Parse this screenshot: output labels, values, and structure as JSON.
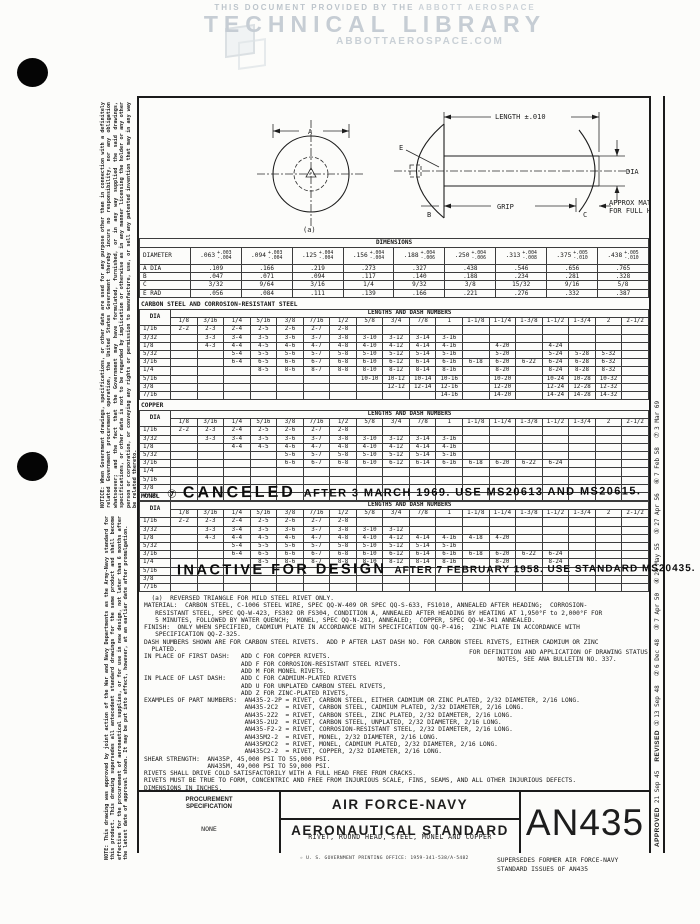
{
  "watermark": {
    "provided_by": "THIS DOCUMENT PROVIDED BY THE",
    "brand": "ABBOTT AEROSPACE",
    "library": "TECHNICAL LIBRARY",
    "site": "ABBOTTAEROSPACE.COM"
  },
  "drawing": {
    "dim_a": "A",
    "caption": "(a)",
    "length": "LENGTH ±.010",
    "e": "E",
    "b": "B",
    "grip": "GRIP",
    "c": "C",
    "dia": "DIA",
    "approx_1": "APPROX MATERIAL",
    "approx_2": "FOR FULL HEAD"
  },
  "dimensions": {
    "title": "DIMENSIONS",
    "row_label": "DIAMETER",
    "diameters": [
      {
        "v": ".063",
        "p": "+.003",
        "m": "-.004"
      },
      {
        "v": ".094",
        "p": "+.003",
        "m": "-.004"
      },
      {
        "v": ".125",
        "p": "+.004",
        "m": "-.004"
      },
      {
        "v": ".156",
        "p": "+.004",
        "m": "-.004"
      },
      {
        "v": ".188",
        "p": "+.004",
        "m": "-.006"
      },
      {
        "v": ".250",
        "p": "+.004",
        "m": "-.006"
      },
      {
        "v": ".313",
        "p": "+.004",
        "m": "-.008"
      },
      {
        "v": ".375",
        "p": "+.005",
        "m": "-.010"
      },
      {
        "v": ".438",
        "p": "+.005",
        "m": "-.010"
      }
    ],
    "rows": [
      {
        "label": "A DIA",
        "values": [
          ".109",
          ".166",
          ".219",
          ".273",
          ".327",
          ".438",
          ".546",
          ".656",
          ".765"
        ]
      },
      {
        "label": "B",
        "values": [
          ".047",
          ".071",
          ".094",
          ".117",
          ".140",
          ".188",
          ".234",
          ".281",
          ".328"
        ]
      },
      {
        "label": "C",
        "values": [
          "3/32",
          "9/64",
          "3/16",
          "1/4",
          "9/32",
          "3/8",
          "15/32",
          "9/16",
          "5/8"
        ]
      },
      {
        "label": "E RAD",
        "values": [
          ".056",
          ".084",
          ".111",
          ".139",
          ".166",
          ".221",
          ".276",
          ".332",
          ".387"
        ]
      }
    ]
  },
  "length_header": {
    "dia": "DIA",
    "title": "LENGTHS AND DASH NUMBERS",
    "columns": [
      "1/8",
      "3/16",
      "1/4",
      "5/16",
      "3/8",
      "7/16",
      "1/2",
      "5/8",
      "3/4",
      "7/8",
      "1",
      "1-1/8",
      "1-1/4",
      "1-3/8",
      "1-1/2",
      "1-3/4",
      "2",
      "2-1/2"
    ]
  },
  "tables": [
    {
      "id": "carbon",
      "title": "CARBON STEEL AND CORROSION-RESISTANT STEEL",
      "rows": [
        {
          "dia": "1/16",
          "cells": [
            "2-2",
            "2-3",
            "2-4",
            "2-5",
            "2-6",
            "2-7",
            "2-8",
            "",
            "",
            "",
            "",
            "",
            "",
            "",
            "",
            "",
            "",
            ""
          ]
        },
        {
          "dia": "3/32",
          "cells": [
            "",
            "3-3",
            "3-4",
            "3-5",
            "3-6",
            "3-7",
            "3-8",
            "3-10",
            "3-12",
            "3-14",
            "3-16",
            "",
            "",
            "",
            "",
            "",
            "",
            ""
          ]
        },
        {
          "dia": "1/8",
          "cells": [
            "",
            "4-3",
            "4-4",
            "4-5",
            "4-6",
            "4-7",
            "4-8",
            "4-10",
            "4-12",
            "4-14",
            "4-16",
            "",
            "4-20",
            "",
            "4-24",
            "",
            "",
            ""
          ]
        },
        {
          "dia": "5/32",
          "cells": [
            "",
            "",
            "5-4",
            "5-5",
            "5-6",
            "5-7",
            "5-8",
            "5-10",
            "5-12",
            "5-14",
            "5-16",
            "",
            "5-20",
            "",
            "5-24",
            "5-28",
            "5-32",
            ""
          ]
        },
        {
          "dia": "3/16",
          "cells": [
            "",
            "",
            "6-4",
            "6-5",
            "6-6",
            "6-7",
            "6-8",
            "6-10",
            "6-12",
            "6-14",
            "6-16",
            "6-18",
            "6-20",
            "6-22",
            "6-24",
            "6-28",
            "6-32",
            ""
          ]
        },
        {
          "dia": "1/4",
          "cells": [
            "",
            "",
            "",
            "8-5",
            "8-6",
            "8-7",
            "8-8",
            "8-10",
            "8-12",
            "8-14",
            "8-16",
            "",
            "8-20",
            "",
            "8-24",
            "8-28",
            "8-32",
            ""
          ]
        },
        {
          "dia": "5/16",
          "cells": [
            "",
            "",
            "",
            "",
            "",
            "",
            "",
            "10-10",
            "10-12",
            "10-14",
            "10-16",
            "",
            "10-20",
            "",
            "10-24",
            "10-28",
            "10-32",
            ""
          ]
        },
        {
          "dia": "3/8",
          "cells": [
            "",
            "",
            "",
            "",
            "",
            "",
            "",
            "",
            "12-12",
            "12-14",
            "12-16",
            "",
            "12-20",
            "",
            "12-24",
            "12-28",
            "12-32",
            ""
          ]
        },
        {
          "dia": "7/16",
          "cells": [
            "",
            "",
            "",
            "",
            "",
            "",
            "",
            "",
            "",
            "",
            "14-16",
            "",
            "14-20",
            "",
            "14-24",
            "14-28",
            "14-32",
            ""
          ]
        }
      ]
    },
    {
      "id": "copper",
      "title": "COPPER",
      "rows": [
        {
          "dia": "1/16",
          "cells": [
            "2-2",
            "2-3",
            "2-4",
            "2-5",
            "2-6",
            "2-7",
            "2-8",
            "",
            "",
            "",
            "",
            "",
            "",
            "",
            "",
            "",
            "",
            ""
          ]
        },
        {
          "dia": "3/32",
          "cells": [
            "",
            "3-3",
            "3-4",
            "3-5",
            "3-6",
            "3-7",
            "3-8",
            "3-10",
            "3-12",
            "3-14",
            "3-16",
            "",
            "",
            "",
            "",
            "",
            "",
            ""
          ]
        },
        {
          "dia": "1/8",
          "cells": [
            "",
            "",
            "4-4",
            "4-5",
            "4-6",
            "4-7",
            "4-8",
            "4-10",
            "4-12",
            "4-14",
            "4-16",
            "",
            "",
            "",
            "",
            "",
            "",
            ""
          ]
        },
        {
          "dia": "5/32",
          "cells": [
            "",
            "",
            "",
            "",
            "5-6",
            "5-7",
            "5-8",
            "5-10",
            "5-12",
            "5-14",
            "5-16",
            "",
            "",
            "",
            "",
            "",
            "",
            ""
          ]
        },
        {
          "dia": "3/16",
          "cells": [
            "",
            "",
            "",
            "",
            "6-6",
            "6-7",
            "6-8",
            "6-10",
            "6-12",
            "6-14",
            "6-16",
            "6-18",
            "6-20",
            "6-22",
            "6-24",
            "",
            "",
            ""
          ]
        },
        {
          "dia": "1/4",
          "cells": [
            "",
            "",
            "",
            "",
            "",
            "",
            "",
            "",
            "",
            "",
            "",
            "",
            "",
            "",
            "",
            "",
            "",
            ""
          ]
        },
        {
          "dia": "5/16",
          "cells": [
            "",
            "",
            "",
            "",
            "",
            "",
            "",
            "",
            "",
            "",
            "",
            "",
            "",
            "",
            "",
            "",
            "",
            ""
          ]
        },
        {
          "dia": "3/8",
          "cells": [
            "",
            "",
            "",
            "",
            "",
            "",
            "",
            "",
            "",
            "",
            "",
            "",
            "",
            "",
            "",
            "",
            "",
            ""
          ]
        },
        {
          "dia": "7/16",
          "cells": [
            "",
            "",
            "",
            "",
            "",
            "",
            "",
            "",
            "",
            "",
            "",
            "",
            "",
            "",
            "",
            "",
            "",
            ""
          ]
        }
      ]
    },
    {
      "id": "monel",
      "title": "MONEL",
      "rows": [
        {
          "dia": "1/16",
          "cells": [
            "2-2",
            "2-3",
            "2-4",
            "2-5",
            "2-6",
            "2-7",
            "2-8",
            "",
            "",
            "",
            "",
            "",
            "",
            "",
            "",
            "",
            "",
            ""
          ]
        },
        {
          "dia": "3/32",
          "cells": [
            "",
            "3-3",
            "3-4",
            "3-5",
            "3-6",
            "3-7",
            "3-8",
            "3-10",
            "3-12",
            "",
            "",
            "",
            "",
            "",
            "",
            "",
            "",
            ""
          ]
        },
        {
          "dia": "1/8",
          "cells": [
            "",
            "4-3",
            "4-4",
            "4-5",
            "4-6",
            "4-7",
            "4-8",
            "4-10",
            "4-12",
            "4-14",
            "4-16",
            "4-18",
            "4-20",
            "",
            "",
            "",
            "",
            ""
          ]
        },
        {
          "dia": "5/32",
          "cells": [
            "",
            "",
            "5-4",
            "5-5",
            "5-6",
            "5-7",
            "5-8",
            "5-10",
            "5-12",
            "5-14",
            "5-16",
            "",
            "",
            "",
            "",
            "",
            "",
            ""
          ]
        },
        {
          "dia": "3/16",
          "cells": [
            "",
            "",
            "6-4",
            "6-5",
            "6-6",
            "6-7",
            "6-8",
            "6-10",
            "6-12",
            "6-14",
            "6-16",
            "6-18",
            "6-20",
            "6-22",
            "6-24",
            "",
            "",
            ""
          ]
        },
        {
          "dia": "1/4",
          "cells": [
            "",
            "",
            "",
            "8-5",
            "8-6",
            "8-7",
            "8-8",
            "8-10",
            "8-12",
            "8-14",
            "8-16",
            "",
            "8-20",
            "",
            "8-24",
            "",
            "",
            ""
          ]
        },
        {
          "dia": "5/16",
          "cells": [
            "",
            "",
            "",
            "",
            "",
            "",
            "",
            "",
            "",
            "",
            "",
            "",
            "",
            "",
            "",
            "",
            "",
            ""
          ]
        },
        {
          "dia": "3/8",
          "cells": [
            "",
            "",
            "",
            "",
            "",
            "",
            "",
            "",
            "",
            "",
            "",
            "",
            "",
            "",
            "",
            "",
            "",
            ""
          ]
        },
        {
          "dia": "7/16",
          "cells": [
            "",
            "",
            "",
            "",
            "",
            "",
            "",
            "",
            "",
            "",
            "",
            "",
            "",
            "",
            "",
            "",
            "",
            ""
          ]
        }
      ]
    }
  ],
  "stamps": {
    "canceled": {
      "num": "⑦",
      "word": "CANCELED",
      "rest": "AFTER 3 MARCH 1969.   USE MS20613 AND MS20615."
    },
    "inactive": {
      "word": "INACTIVE FOR DESIGN",
      "rest": "AFTER 7 FEBRUARY 1958.  USE STANDARD MS20435."
    }
  },
  "notes": {
    "lines": [
      "  (a)  REVERSED TRIANGLE FOR MILD STEEL RIVET ONLY.",
      "MATERIAL:  CARBON STEEL, C-1006 STEEL WIRE, SPEC QQ-W-409 OR SPEC QQ-S-633, FS1010, ANNEALED AFTER HEADING;  CORROSION-",
      "   RESISTANT STEEL, SPEC QQ-W-423, FS302 OR FS304, CONDITION A, ANNEALED AFTER HEADING BY HEATING AT 1,950°F to 2,000°F FOR",
      "   5 MINUTES, FOLLOWED BY WATER QUENCH;  MONEL, SPEC QQ-N-281, ANNEALED;  COPPER, SPEC QQ-W-341 ANNEALED.",
      "FINISH:  ONLY WHEN SPECIFIED, CADMIUM PLATE IN ACCORDANCE WITH SPECIFICATION QQ-P-416;  ZINC PLATE IN ACCORDANCE WITH",
      "   SPECIFICATION QQ-Z-325.",
      "DASH NUMBERS SHOWN ARE FOR CARBON STEEL RIVETS.  ADD P AFTER LAST DASH NO. FOR CARBON STEEL RIVETS, EITHER CADMIUM OR ZINC",
      "  PLATED.",
      "IN PLACE OF FIRST DASH:   ADD C FOR COPPER RIVETS.",
      "                          ADD F FOR CORROSION-RESISTANT STEEL RIVETS.",
      "                          ADD M FOR MONEL RIVETS.",
      "IN PLACE OF LAST DASH:    ADD C FOR CADMIUM-PLATED RIVETS",
      "                          ADD U FOR UNPLATED CARBON STEEL RIVETS,",
      "                          ADD Z FOR ZINC-PLATED RIVETS,",
      "EXAMPLES OF PART NUMBERS:  AN435-2-2P = RIVET, CARBON STEEL, EITHER CADMIUM OR ZINC PLATED, 2/32 DIAMETER, 2/16 LONG.",
      "                           AN435-2C2  = RIVET, CARBON STEEL, CADMIUM PLATED, 2/32 DIAMETER, 2/16 LONG.",
      "                           AN435-2Z2  = RIVET, CARBON STEEL, ZINC PLATED, 2/32 DIAMETER, 2/16 LONG.",
      "                           AN435-2U2  = RIVET, CARBON STEEL, UNPLATED, 2/32 DIAMETER, 2/16 LONG.",
      "                           AN435-F2-2 = RIVET, CORROSION-RESISTANT STEEL, 2/32 DIAMETER, 2/16 LONG.",
      "                           AN435M2-2  = RIVET, MONEL, 2/32 DIAMETER, 2/16 LONG.",
      "                           AN435M2C2  = RIVET, MONEL, CADMIUM PLATED, 2/32 DIAMETER, 2/16 LONG.",
      "                           AN435C2-2  = RIVET, COPPER, 2/32 DIAMETER, 2/16 LONG.",
      "SHEAR STRENGTH:  AN435P, 45,000 PSI TO 55,000 PSI.",
      "                 AN435M, 49,000 PSI TO 59,000 PSI.",
      "RIVETS SHALL DRIVE COLD SATISFACTORILY WITH A FULL HEAD FREE FROM CRACKS.",
      "RIVETS MUST BE TRUE TO FORM, CONCENTRIC AND FREE FROM INJURIOUS SCALE, FINS, SEAMS, AND ALL OTHER INJURIOUS DEFECTS.",
      "DIMENSIONS IN INCHES."
    ],
    "status_note_1": "FOR DEFINITION AND APPLICATION OF DRAWING STATUS",
    "status_note_2": "NOTES, SEE ANA BULLETIN NO. 337."
  },
  "title_block": {
    "proc_label_1": "PROCUREMENT",
    "proc_label_2": "SPECIFICATION",
    "proc_value": "NONE",
    "standard": "AIR FORCE-NAVY AERONAUTICAL STANDARD",
    "subtitle": "RIVET, ROUND HEAD, STEEL, MONEL AND COPPER",
    "number": "AN435"
  },
  "footer": {
    "printing": "☆ U. S. GOVERNMENT PRINTING OFFICE: 1959-341-538/A-5482",
    "supersedes_1": "SUPERSEDES FORMER AIR FORCE-NAVY",
    "supersedes_2": "STANDARD ISSUES OF AN435"
  },
  "side_notes": {
    "notice": "NOTICE: When Government drawings, specifications, or other data are used for any purpose other than in connection with a definitely related Government procurement operation, the United States Government thereby incurs no responsibility, nor any obligation whatsoever; and the fact that the Government may have formulated, furnished, or in any way supplied the said drawings, specifications, or other data is not to be regarded by implication or otherwise as in any manner licensing the holder or any other person or corporation, or conveying any rights or permission to manufacture, use, or sell any patented invention that may in any way be related thereto.",
    "note": "NOTE: This drawing was approved by joint action of the War and Navy Departments as the Army-Navy standard for this product. This drawing supersedes all antecedent standard drawings for the same product and shall become effective for the procurement of aeronautical supplies, or for use in new design, not later than 6 months after the latest date of approval shown. It may be put into effect, however, at an earlier date after promulgation."
  },
  "revision_strip": {
    "approved_label": "APPROVED",
    "approved_date": "21 Sep 45",
    "revised_label": "REVISED",
    "revisions": [
      {
        "n": "①",
        "d": "13 Sep 48"
      },
      {
        "n": "②",
        "d": "6 Dec 48"
      },
      {
        "n": "③",
        "d": "7 Apr 50"
      },
      {
        "n": "④",
        "d": "24 May 55"
      },
      {
        "n": "⑤",
        "d": "27 Apr 56"
      },
      {
        "n": "⑥",
        "d": "7 Feb 58"
      },
      {
        "n": "⑦",
        "d": "3 Mar 69"
      }
    ]
  }
}
